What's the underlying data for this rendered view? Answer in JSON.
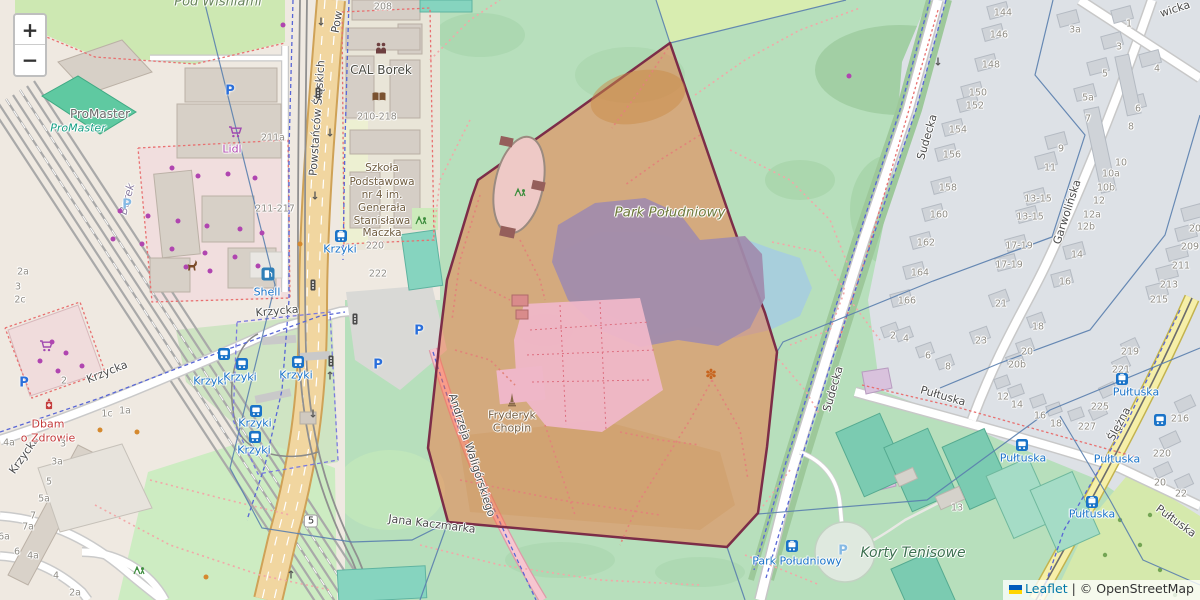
{
  "map": {
    "zoom_in": "+",
    "zoom_out": "−",
    "route_shield": "5",
    "attribution": {
      "leaflet": "Leaflet",
      "sep": " | ",
      "copyright": "© OpenStreetMap"
    },
    "colors": {
      "selected_region_fill": "#fa6630",
      "selected_region_border": "#7c2d48",
      "park_green": "#b7dfbc",
      "water_blue": "#a8cfdc",
      "transit_blue": "#1a73c8"
    }
  },
  "labels": [
    {
      "t": "Powstańców Ś​ląskich",
      "x": 317,
      "y": 118,
      "c": "street",
      "r": -86
    },
    {
      "t": "Pow",
      "x": 337,
      "y": 22,
      "c": "street",
      "r": -80
    },
    {
      "t": "Krzycka",
      "x": 107,
      "y": 372,
      "c": "street",
      "r": -22
    },
    {
      "t": "Krzycka",
      "x": 24,
      "y": 455,
      "c": "street",
      "r": -55
    },
    {
      "t": "Krzycka",
      "x": 277,
      "y": 311,
      "c": "street",
      "r": -5
    },
    {
      "t": "Sudecka",
      "x": 927,
      "y": 137,
      "c": "street",
      "r": -74
    },
    {
      "t": "Sudecka",
      "x": 833,
      "y": 389,
      "c": "street",
      "r": -74
    },
    {
      "t": "Garwolińska",
      "x": 1067,
      "y": 212,
      "c": "street",
      "r": -72
    },
    {
      "t": "Ślężna",
      "x": 1119,
      "y": 424,
      "c": "street",
      "r": -62
    },
    {
      "t": "Pułtuska",
      "x": 943,
      "y": 396,
      "c": "street",
      "r": 16
    },
    {
      "t": "Pułtuska",
      "x": 1176,
      "y": 521,
      "c": "street",
      "r": 36
    },
    {
      "t": "wicka",
      "x": 1175,
      "y": 9,
      "c": "street",
      "r": -18
    },
    {
      "t": "Jana Kaczmarka",
      "x": 432,
      "y": 524,
      "c": "street",
      "r": 7
    },
    {
      "t": "Andrzeja Waligórskiego",
      "x": 472,
      "y": 455,
      "c": "street",
      "r": 72
    },
    {
      "t": "Borek",
      "x": 127,
      "y": 199,
      "c": "district",
      "r": -75
    },
    {
      "t": "Krzyki",
      "x": 210,
      "y": 381,
      "c": "transit"
    },
    {
      "t": "Krzyki",
      "x": 240,
      "y": 377,
      "c": "transit"
    },
    {
      "t": "Krzyki",
      "x": 296,
      "y": 375,
      "c": "transit"
    },
    {
      "t": "Krzyki",
      "x": 255,
      "y": 423,
      "c": "transit"
    },
    {
      "t": "Krzyki",
      "x": 254,
      "y": 450,
      "c": "transit"
    },
    {
      "t": "Krzyki",
      "x": 340,
      "y": 249,
      "c": "transit"
    },
    {
      "t": "Shell",
      "x": 267,
      "y": 292,
      "c": "transit"
    },
    {
      "t": "Pułtuska",
      "x": 1023,
      "y": 458,
      "c": "transit"
    },
    {
      "t": "Pułtuska",
      "x": 1136,
      "y": 392,
      "c": "transit"
    },
    {
      "t": "Pułtuska",
      "x": 1117,
      "y": 459,
      "c": "transit"
    },
    {
      "t": "Pułtuska",
      "x": 1092,
      "y": 514,
      "c": "transit"
    },
    {
      "t": "Park Południowy",
      "x": 797,
      "y": 561,
      "c": "transit"
    },
    {
      "t": "ProMaster",
      "x": 100,
      "y": 114,
      "c": "poi-gray"
    },
    {
      "t": "ProMaster",
      "x": 78,
      "y": 128,
      "c": "poi-teal"
    },
    {
      "t": "Lidl",
      "x": 232,
      "y": 149,
      "c": "poi-purple"
    },
    {
      "t": "CAL Borek",
      "x": 381,
      "y": 70,
      "c": "poi-dark"
    },
    {
      "t": "Dbam",
      "x": 48,
      "y": 424,
      "c": "poi-red"
    },
    {
      "t": "o Zdrowie",
      "x": 48,
      "y": 438,
      "c": "poi-red"
    },
    {
      "t": "Szkoła",
      "x": 382,
      "y": 168,
      "c": "poi-school"
    },
    {
      "t": "Podstawowa",
      "x": 382,
      "y": 182,
      "c": "poi-school"
    },
    {
      "t": "nr 4 im.",
      "x": 382,
      "y": 195,
      "c": "poi-school"
    },
    {
      "t": "Generała",
      "x": 382,
      "y": 208,
      "c": "poi-school"
    },
    {
      "t": "Stanisława",
      "x": 382,
      "y": 221,
      "c": "poi-school"
    },
    {
      "t": "Maczka",
      "x": 382,
      "y": 233,
      "c": "poi-school"
    },
    {
      "t": "Park Południowy",
      "x": 670,
      "y": 213,
      "c": "poi-park"
    },
    {
      "t": "Korty Tenisowe",
      "x": 913,
      "y": 553,
      "c": "poi-sport"
    },
    {
      "t": "Fryderyk",
      "x": 512,
      "y": 415,
      "c": "poi-brown"
    },
    {
      "t": "Chopin",
      "x": 512,
      "y": 428,
      "c": "poi-brown"
    },
    {
      "t": "Pod Wiśniami",
      "x": 218,
      "y": 2,
      "c": "poi-allot"
    }
  ],
  "house_numbers": [
    {
      "t": "208",
      "x": 383,
      "y": 7
    },
    {
      "t": "211a",
      "x": 273,
      "y": 138
    },
    {
      "t": "211-217",
      "x": 275,
      "y": 209
    },
    {
      "t": "210-218",
      "x": 377,
      "y": 117
    },
    {
      "t": "220",
      "x": 375,
      "y": 246
    },
    {
      "t": "222",
      "x": 378,
      "y": 274
    },
    {
      "t": "2a",
      "x": 23,
      "y": 272
    },
    {
      "t": "3",
      "x": 18,
      "y": 287
    },
    {
      "t": "2c",
      "x": 20,
      "y": 300
    },
    {
      "t": "2",
      "x": 64,
      "y": 381
    },
    {
      "t": "1c",
      "x": 107,
      "y": 414
    },
    {
      "t": "1a",
      "x": 125,
      "y": 411
    },
    {
      "t": "4a",
      "x": 9,
      "y": 443
    },
    {
      "t": "3",
      "x": 63,
      "y": 444
    },
    {
      "t": "3a",
      "x": 57,
      "y": 462
    },
    {
      "t": "5",
      "x": 49,
      "y": 482
    },
    {
      "t": "5a",
      "x": 44,
      "y": 499
    },
    {
      "t": "7",
      "x": 33,
      "y": 516
    },
    {
      "t": "7a",
      "x": 28,
      "y": 527
    },
    {
      "t": "6a",
      "x": 4,
      "y": 537
    },
    {
      "t": "6",
      "x": 17,
      "y": 552
    },
    {
      "t": "4a",
      "x": 33,
      "y": 556
    },
    {
      "t": "4",
      "x": 56,
      "y": 576
    },
    {
      "t": "2a",
      "x": 75,
      "y": 593
    },
    {
      "t": "144",
      "x": 1003,
      "y": 13
    },
    {
      "t": "146",
      "x": 999,
      "y": 35
    },
    {
      "t": "148",
      "x": 991,
      "y": 65
    },
    {
      "t": "150",
      "x": 978,
      "y": 93
    },
    {
      "t": "152",
      "x": 975,
      "y": 106
    },
    {
      "t": "154",
      "x": 958,
      "y": 130
    },
    {
      "t": "156",
      "x": 952,
      "y": 155
    },
    {
      "t": "158",
      "x": 948,
      "y": 188
    },
    {
      "t": "160",
      "x": 939,
      "y": 215
    },
    {
      "t": "162",
      "x": 926,
      "y": 243
    },
    {
      "t": "164",
      "x": 920,
      "y": 273
    },
    {
      "t": "166",
      "x": 907,
      "y": 301
    },
    {
      "t": "3a",
      "x": 1075,
      "y": 30
    },
    {
      "t": "1",
      "x": 1129,
      "y": 24
    },
    {
      "t": "3",
      "x": 1119,
      "y": 47
    },
    {
      "t": "5",
      "x": 1105,
      "y": 74
    },
    {
      "t": "4",
      "x": 1157,
      "y": 69
    },
    {
      "t": "5a",
      "x": 1088,
      "y": 98
    },
    {
      "t": "7",
      "x": 1088,
      "y": 119
    },
    {
      "t": "6",
      "x": 1138,
      "y": 109
    },
    {
      "t": "8",
      "x": 1131,
      "y": 127
    },
    {
      "t": "9",
      "x": 1061,
      "y": 149
    },
    {
      "t": "11",
      "x": 1050,
      "y": 168
    },
    {
      "t": "10",
      "x": 1121,
      "y": 163
    },
    {
      "t": "10a",
      "x": 1111,
      "y": 174
    },
    {
      "t": "10b",
      "x": 1106,
      "y": 188
    },
    {
      "t": "12",
      "x": 1099,
      "y": 201
    },
    {
      "t": "12a",
      "x": 1092,
      "y": 215
    },
    {
      "t": "12b",
      "x": 1086,
      "y": 227
    },
    {
      "t": "13-15",
      "x": 1038,
      "y": 199
    },
    {
      "t": "13-15",
      "x": 1030,
      "y": 217
    },
    {
      "t": "17-19",
      "x": 1019,
      "y": 246
    },
    {
      "t": "17-19",
      "x": 1009,
      "y": 265
    },
    {
      "t": "14",
      "x": 1077,
      "y": 255
    },
    {
      "t": "16",
      "x": 1065,
      "y": 282
    },
    {
      "t": "20",
      "x": 1195,
      "y": 229
    },
    {
      "t": "209",
      "x": 1190,
      "y": 247
    },
    {
      "t": "211",
      "x": 1181,
      "y": 266
    },
    {
      "t": "213",
      "x": 1169,
      "y": 285
    },
    {
      "t": "215",
      "x": 1159,
      "y": 300
    },
    {
      "t": "2",
      "x": 893,
      "y": 336
    },
    {
      "t": "4",
      "x": 906,
      "y": 339
    },
    {
      "t": "6",
      "x": 928,
      "y": 356
    },
    {
      "t": "8",
      "x": 948,
      "y": 367
    },
    {
      "t": "21",
      "x": 1001,
      "y": 304
    },
    {
      "t": "23",
      "x": 981,
      "y": 341
    },
    {
      "t": "18",
      "x": 1038,
      "y": 327
    },
    {
      "t": "20",
      "x": 1027,
      "y": 352
    },
    {
      "t": "20b",
      "x": 1017,
      "y": 365
    },
    {
      "t": "12",
      "x": 1003,
      "y": 397
    },
    {
      "t": "14",
      "x": 1017,
      "y": 405
    },
    {
      "t": "16",
      "x": 1040,
      "y": 416
    },
    {
      "t": "18",
      "x": 1056,
      "y": 424
    },
    {
      "t": "227",
      "x": 1087,
      "y": 427
    },
    {
      "t": "219",
      "x": 1130,
      "y": 352
    },
    {
      "t": "221",
      "x": 1121,
      "y": 370
    },
    {
      "t": "225",
      "x": 1100,
      "y": 407
    },
    {
      "t": "216",
      "x": 1180,
      "y": 419
    },
    {
      "t": "220",
      "x": 1162,
      "y": 454
    },
    {
      "t": "20",
      "x": 1160,
      "y": 483
    },
    {
      "t": "22",
      "x": 1181,
      "y": 494
    },
    {
      "t": "13",
      "x": 957,
      "y": 508
    }
  ],
  "icons": [
    {
      "k": "parking",
      "x": 230,
      "y": 91
    },
    {
      "k": "parking",
      "x": 419,
      "y": 331
    },
    {
      "k": "parking",
      "x": 378,
      "y": 365
    },
    {
      "k": "parking",
      "x": 24,
      "y": 383
    },
    {
      "k": "parking-light",
      "x": 127,
      "y": 205
    },
    {
      "k": "parking-light",
      "x": 843,
      "y": 551
    },
    {
      "k": "bus",
      "x": 224,
      "y": 354
    },
    {
      "k": "bus",
      "x": 242,
      "y": 364
    },
    {
      "k": "bus",
      "x": 298,
      "y": 362
    },
    {
      "k": "bus",
      "x": 256,
      "y": 411
    },
    {
      "k": "bus",
      "x": 255,
      "y": 437
    },
    {
      "k": "bus",
      "x": 1022,
      "y": 445
    },
    {
      "k": "bus",
      "x": 1160,
      "y": 420
    },
    {
      "k": "tram",
      "x": 341,
      "y": 236
    },
    {
      "k": "tram",
      "x": 792,
      "y": 546
    },
    {
      "k": "tram",
      "x": 1122,
      "y": 379
    },
    {
      "k": "tram",
      "x": 1092,
      "y": 502
    },
    {
      "k": "fuel",
      "x": 268,
      "y": 274
    },
    {
      "k": "pharmacy",
      "x": 49,
      "y": 404
    },
    {
      "k": "cart",
      "x": 46,
      "y": 346
    },
    {
      "k": "cart",
      "x": 235,
      "y": 132
    },
    {
      "k": "people",
      "x": 381,
      "y": 48
    },
    {
      "k": "book",
      "x": 379,
      "y": 97
    },
    {
      "k": "playground",
      "x": 520,
      "y": 192
    },
    {
      "k": "playground",
      "x": 421,
      "y": 220
    },
    {
      "k": "playground",
      "x": 139,
      "y": 570
    },
    {
      "k": "flower",
      "x": 711,
      "y": 375
    },
    {
      "k": "monument",
      "x": 512,
      "y": 400
    },
    {
      "k": "animal",
      "x": 192,
      "y": 265
    },
    {
      "k": "trafficlight",
      "x": 313,
      "y": 285
    },
    {
      "k": "trafficlight",
      "x": 355,
      "y": 319
    },
    {
      "k": "trafficlight",
      "x": 331,
      "y": 361
    },
    {
      "k": "trafficlight",
      "x": 318,
      "y": 93
    },
    {
      "k": "arrow-down",
      "x": 321,
      "y": 22
    },
    {
      "k": "arrow-down",
      "x": 330,
      "y": 133
    },
    {
      "k": "arrow-down",
      "x": 315,
      "y": 196
    },
    {
      "k": "arrow-down",
      "x": 313,
      "y": 414
    },
    {
      "k": "arrow-down",
      "x": 938,
      "y": 62
    },
    {
      "k": "arrow-up",
      "x": 330,
      "y": 376
    },
    {
      "k": "arrow-up",
      "x": 291,
      "y": 575
    },
    {
      "k": "shield",
      "x": 311,
      "y": 521
    }
  ],
  "dots": {
    "purple": [
      [
        172,
        168
      ],
      [
        198,
        176
      ],
      [
        228,
        174
      ],
      [
        255,
        178
      ],
      [
        120,
        211
      ],
      [
        148,
        216
      ],
      [
        178,
        221
      ],
      [
        207,
        226
      ],
      [
        240,
        229
      ],
      [
        262,
        233
      ],
      [
        113,
        239
      ],
      [
        142,
        244
      ],
      [
        172,
        249
      ],
      [
        205,
        253
      ],
      [
        235,
        257
      ],
      [
        258,
        266
      ],
      [
        210,
        271
      ],
      [
        186,
        267
      ],
      [
        52,
        342
      ],
      [
        66,
        353
      ],
      [
        40,
        361
      ],
      [
        82,
        366
      ],
      [
        58,
        371
      ],
      [
        283,
        25
      ],
      [
        849,
        76
      ]
    ],
    "orange": [
      [
        100,
        430
      ],
      [
        137,
        432
      ],
      [
        300,
        244
      ],
      [
        206,
        577
      ]
    ]
  }
}
